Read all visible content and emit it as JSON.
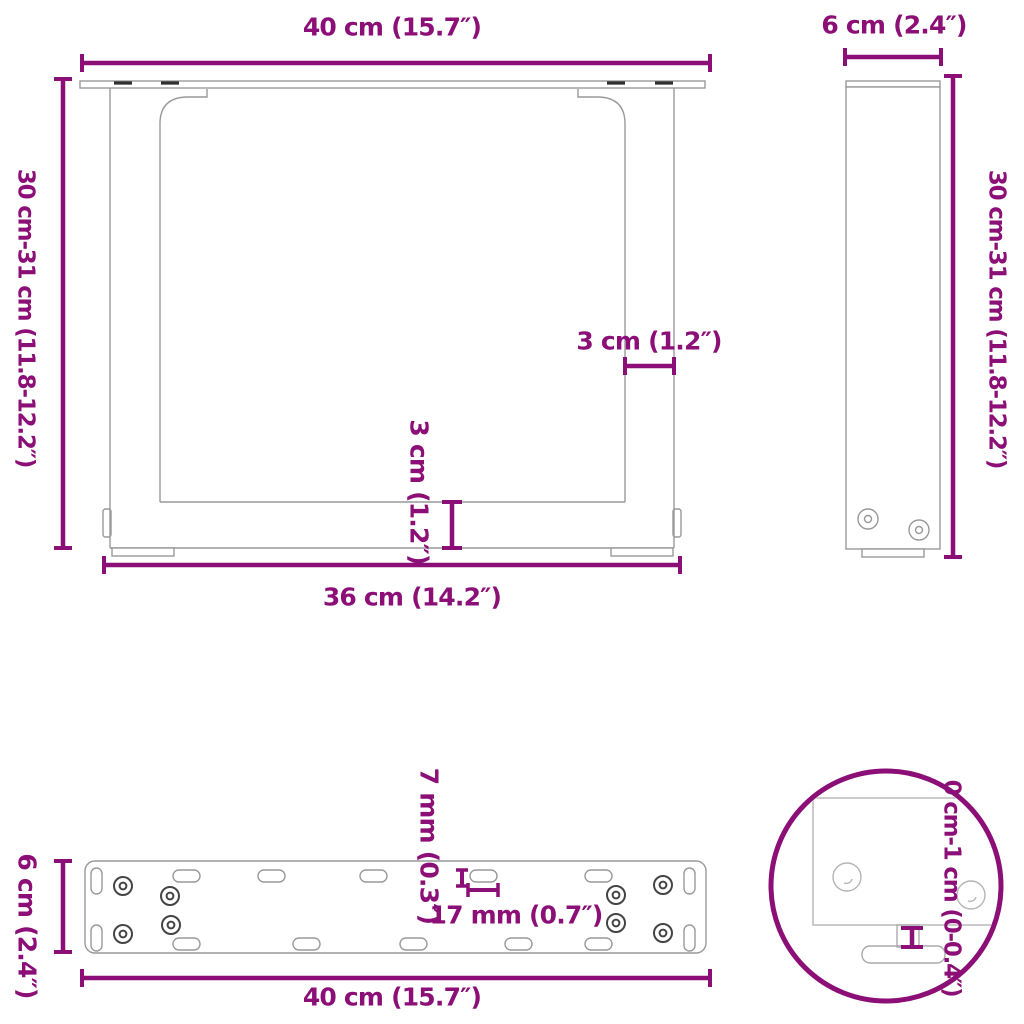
{
  "colors": {
    "accent": "#8B0F76",
    "drawing_line": "#999999",
    "faint_line": "#b5b5b5",
    "hole_ring": "#444444",
    "slot_mark": "#2f2f2f",
    "background": "#ffffff"
  },
  "views": {
    "front": {
      "labels": {
        "width_top": "40 cm (15.7″)",
        "height_left": "30 cm-31 cm (11.8-12.2″)",
        "leg_width": "3 cm (1.2″)",
        "bar_height": "3 cm (1.2″)",
        "width_bottom": "36 cm (14.2″)"
      }
    },
    "side": {
      "labels": {
        "depth_top": "6 cm (2.4″)",
        "height_right": "30 cm-31 cm (11.8-12.2″)"
      }
    },
    "plate": {
      "labels": {
        "depth_left": "6 cm (2.4″)",
        "width_bottom": "40 cm (15.7″)",
        "slot_width": "7 mm (0.3″)",
        "slot_length": "17 mm (0.7″)"
      }
    },
    "detail": {
      "labels": {
        "adjustable_range": "0 cm-1 cm (0-0.4″)"
      }
    }
  }
}
